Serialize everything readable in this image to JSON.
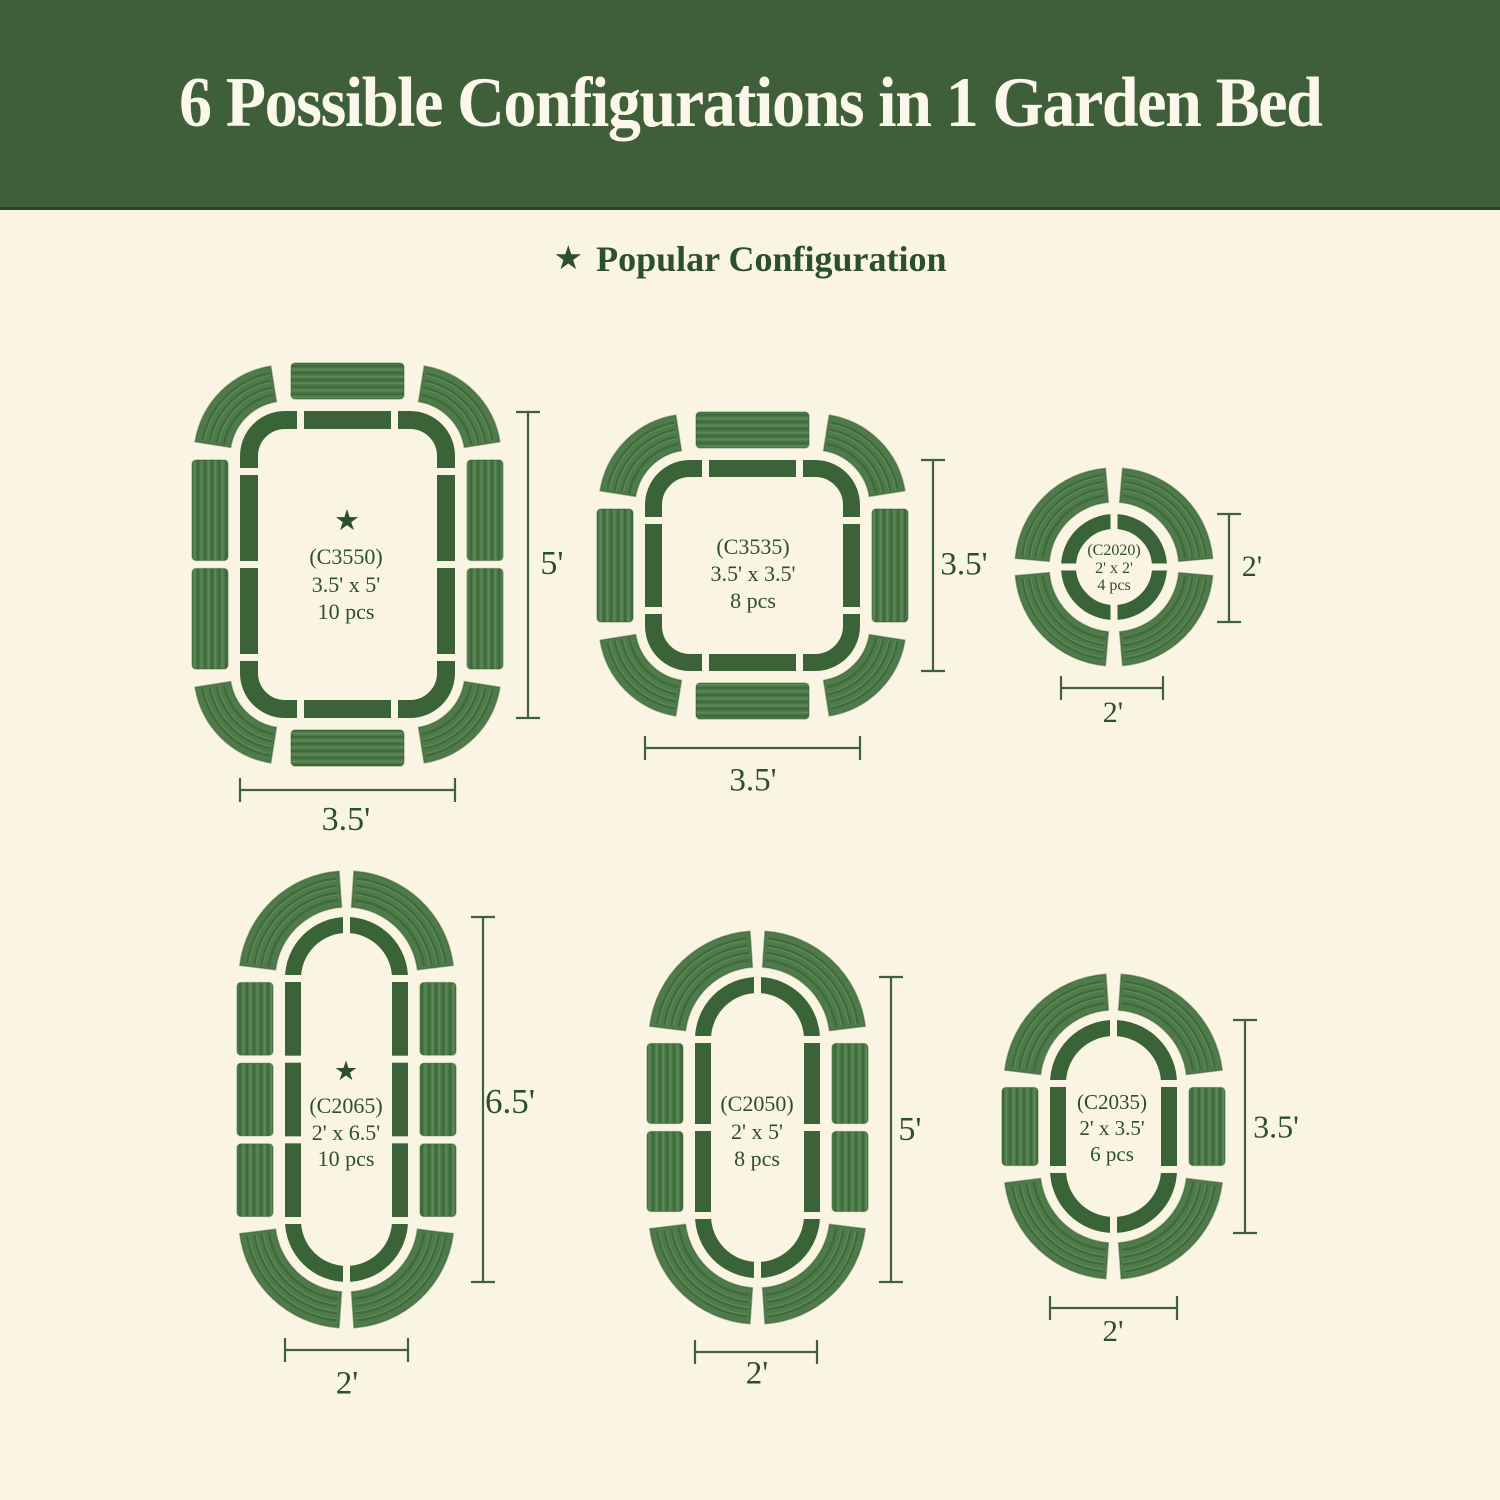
{
  "title": "6 Possible Configurations in 1 Garden Bed",
  "legend": {
    "star_glyph": "★",
    "label": "Popular Configuration"
  },
  "colors": {
    "banner": "#3f5e3a",
    "title_text": "#fbf7eb",
    "background": "#faf4e3",
    "bed": "#3a6337",
    "panel_base": "#4f7b4a",
    "panel_ridge_dark": "#3e6a3c",
    "panel_ridge_light": "#5f8c58",
    "panel_edge": "#2e5129",
    "text": "#2c4f2c",
    "dim": "#3f6339"
  },
  "configs": [
    {
      "code": "(C3550)",
      "size_text": "3.5' x 5'",
      "pieces": "10 pcs",
      "popular": true,
      "height_label": "5'",
      "width_label": "3.5'",
      "geometry": {
        "shape": "rect",
        "x": 240,
        "y": 411,
        "w": 215,
        "h": 307,
        "r": 45,
        "sw": 18,
        "side_segs": 2,
        "top_segs": 1
      },
      "vdim": {
        "x": 528,
        "y1": 412,
        "y2": 718
      },
      "hdim": {
        "y": 790,
        "x1": 240,
        "x2": 455
      },
      "labels": {
        "star": {
          "x": 347,
          "y": 507,
          "fs": 29
        },
        "text": {
          "x": 346,
          "y": 543,
          "fs": 22,
          "lh": 27.5
        },
        "vlabel": {
          "x": 552,
          "y": 564,
          "fs": 34
        },
        "hlabel": {
          "x": 346,
          "y": 820,
          "fs": 34
        }
      }
    },
    {
      "code": "(C3535)",
      "size_text": "3.5' x 3.5'",
      "pieces": "8 pcs",
      "popular": false,
      "height_label": "3.5'",
      "width_label": "3.5'",
      "geometry": {
        "shape": "rect",
        "x": 645,
        "y": 460,
        "w": 215,
        "h": 211,
        "r": 45,
        "sw": 17,
        "side_segs": 1,
        "top_segs": 1
      },
      "vdim": {
        "x": 933,
        "y1": 460,
        "y2": 671
      },
      "hdim": {
        "y": 748,
        "x1": 645,
        "x2": 860
      },
      "labels": {
        "star": {
          "x": 0,
          "y": 0,
          "fs": 0
        },
        "text": {
          "x": 753,
          "y": 533,
          "fs": 22,
          "lh": 27
        },
        "vlabel": {
          "x": 964,
          "y": 565,
          "fs": 33
        },
        "hlabel": {
          "x": 753,
          "y": 781,
          "fs": 33
        }
      }
    },
    {
      "code": "(C2020)",
      "size_text": "2' x 2'",
      "pieces": "4 pcs",
      "popular": false,
      "height_label": "2'",
      "width_label": "2'",
      "geometry": {
        "shape": "circle",
        "cx": 1114,
        "cy": 567,
        "R": 53,
        "sw": 15
      },
      "vdim": {
        "x": 1229,
        "y1": 514,
        "y2": 622
      },
      "hdim": {
        "y": 688,
        "x1": 1061,
        "x2": 1163
      },
      "labels": {
        "star": {
          "x": 0,
          "y": 0,
          "fs": 0
        },
        "text": {
          "x": 1114,
          "y": 542,
          "fs": 16,
          "lh": 17.5
        },
        "vlabel": {
          "x": 1252,
          "y": 567,
          "fs": 30
        },
        "hlabel": {
          "x": 1113,
          "y": 713,
          "fs": 30
        }
      }
    },
    {
      "code": "(C2065)",
      "size_text": "2' x 6.5'",
      "pieces": "10 pcs",
      "popular": true,
      "height_label": "6.5'",
      "width_label": "2'",
      "geometry": {
        "shape": "capsule",
        "x": 285,
        "y": 917,
        "w": 123,
        "h": 365,
        "sw": 16,
        "side_segs": 3,
        "top_segs": 0
      },
      "vdim": {
        "x": 483,
        "y1": 917,
        "y2": 1282
      },
      "hdim": {
        "y": 1350,
        "x1": 285,
        "x2": 408
      },
      "labels": {
        "star": {
          "x": 346,
          "y": 1058,
          "fs": 27
        },
        "text": {
          "x": 346,
          "y": 1093,
          "fs": 22,
          "lh": 26.5
        },
        "vlabel": {
          "x": 510,
          "y": 1102,
          "fs": 35
        },
        "hlabel": {
          "x": 347,
          "y": 1384,
          "fs": 33
        }
      }
    },
    {
      "code": "(C2050)",
      "size_text": "2' x 5'",
      "pieces": "8 pcs",
      "popular": false,
      "height_label": "5'",
      "width_label": "2'",
      "geometry": {
        "shape": "capsule",
        "x": 695,
        "y": 977,
        "w": 125,
        "h": 301,
        "sw": 16,
        "side_segs": 2,
        "top_segs": 0
      },
      "vdim": {
        "x": 891,
        "y1": 977,
        "y2": 1282
      },
      "hdim": {
        "y": 1352,
        "x1": 695,
        "x2": 817
      },
      "labels": {
        "star": {
          "x": 0,
          "y": 0,
          "fs": 0
        },
        "text": {
          "x": 757,
          "y": 1090,
          "fs": 22,
          "lh": 27.5
        },
        "vlabel": {
          "x": 910,
          "y": 1130,
          "fs": 34
        },
        "hlabel": {
          "x": 757,
          "y": 1374,
          "fs": 33
        }
      }
    },
    {
      "code": "(C2035)",
      "size_text": "2' x 3.5'",
      "pieces": "6 pcs",
      "popular": false,
      "height_label": "3.5'",
      "width_label": "2'",
      "geometry": {
        "shape": "capsule",
        "x": 1050,
        "y": 1020,
        "w": 127,
        "h": 213,
        "sw": 16,
        "side_segs": 1,
        "top_segs": 0
      },
      "vdim": {
        "x": 1245,
        "y1": 1020,
        "y2": 1233
      },
      "hdim": {
        "y": 1308,
        "x1": 1050,
        "x2": 1177
      },
      "labels": {
        "star": {
          "x": 0,
          "y": 0,
          "fs": 0
        },
        "text": {
          "x": 1112,
          "y": 1089,
          "fs": 21,
          "lh": 26
        },
        "vlabel": {
          "x": 1276,
          "y": 1127,
          "fs": 32
        },
        "hlabel": {
          "x": 1113,
          "y": 1331,
          "fs": 31
        }
      }
    }
  ]
}
